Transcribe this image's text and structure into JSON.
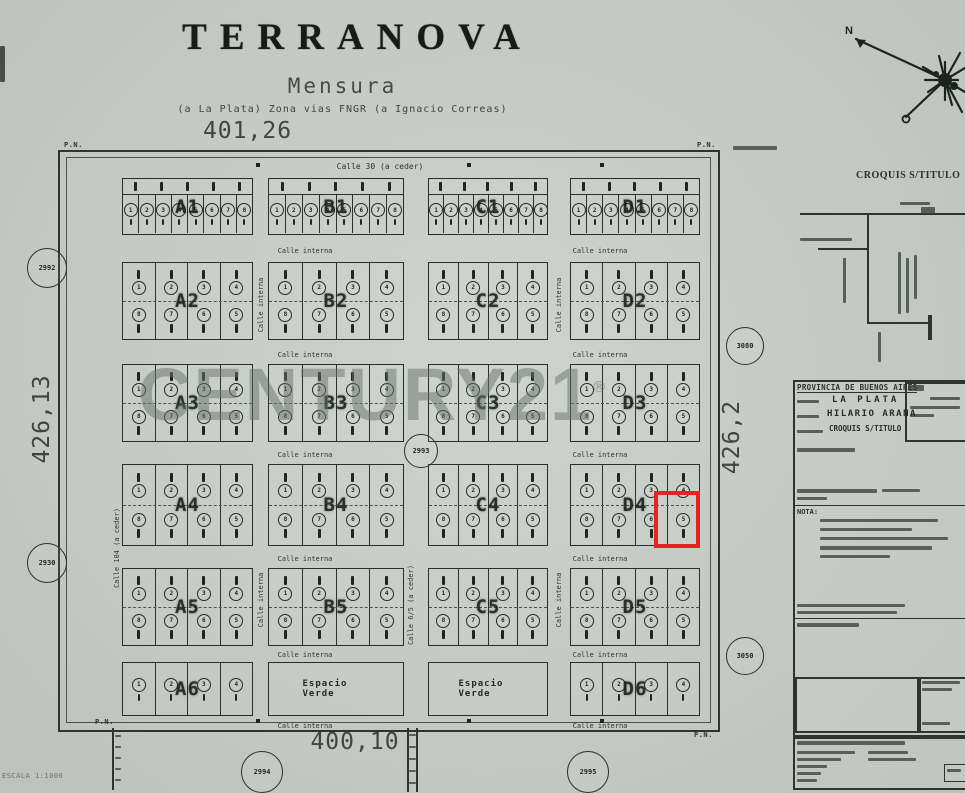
{
  "title": "TERRANOVA",
  "subtitle": "Mensura",
  "subtitle2": "(a La Plata) Zona vias FNGR (a Ignacio Correas)",
  "dimensions": {
    "top": "401,26",
    "left": "426,13",
    "right": "426,2",
    "bottom": "400,10"
  },
  "scale_note": "ESCALA 1:1000",
  "corner_label": "P.N.",
  "espacio_verde": "Espacio Verde",
  "watermark": {
    "text": "CENTURY21",
    "reg": "®"
  },
  "compass": {
    "north": "N"
  },
  "highlight_color": "#e42420",
  "streets": {
    "top": {
      "text": "Calle 30 (a ceder)",
      "x": 380,
      "y": 162
    },
    "internal_label": "Calle interna",
    "internal_positions": [
      [
        305,
        247
      ],
      [
        600,
        247
      ],
      [
        305,
        351
      ],
      [
        600,
        351
      ],
      [
        305,
        451
      ],
      [
        600,
        451
      ],
      [
        305,
        555
      ],
      [
        600,
        555
      ],
      [
        305,
        651
      ],
      [
        600,
        651
      ],
      [
        305,
        722
      ],
      [
        600,
        722
      ]
    ],
    "vertical": [
      {
        "text": "Calle 104 (a ceder)",
        "x": 117,
        "y": 548
      },
      {
        "text": "Calle 6/5 (a ceder)",
        "x": 411,
        "y": 605
      },
      {
        "text": "Calle interna",
        "x": 261,
        "y": 305
      },
      {
        "text": "Calle interna",
        "x": 559,
        "y": 305
      },
      {
        "text": "Calle interna",
        "x": 261,
        "y": 600
      },
      {
        "text": "Calle interna",
        "x": 559,
        "y": 600
      }
    ]
  },
  "map": {
    "frame": {
      "x": 58,
      "y": 150,
      "w": 658,
      "h": 578
    },
    "inner": {
      "x": 66,
      "y": 157,
      "w": 643,
      "h": 564
    },
    "columns": [
      {
        "x": 122,
        "w": 131
      },
      {
        "x": 268,
        "w": 136
      },
      {
        "x": 428,
        "w": 120
      },
      {
        "x": 570,
        "w": 130
      }
    ],
    "rows": [
      {
        "y": 178,
        "h": 57,
        "kind": "strip",
        "blocks": [
          "A1",
          "B1",
          "C1",
          "D1"
        ]
      },
      {
        "y": 262,
        "h": 78,
        "kind": "quad",
        "blocks": [
          "A2",
          "B2",
          "C2",
          "D2"
        ]
      },
      {
        "y": 364,
        "h": 78,
        "kind": "quad",
        "blocks": [
          "A3",
          "B3",
          "C3",
          "D3"
        ]
      },
      {
        "y": 464,
        "h": 82,
        "kind": "quad",
        "blocks": [
          "A4",
          "B4",
          "C4",
          "D4"
        ]
      },
      {
        "y": 568,
        "h": 78,
        "kind": "quad",
        "blocks": [
          "A5",
          "B5",
          "C5",
          "D5"
        ]
      },
      {
        "y": 662,
        "h": 54,
        "kind": "flat",
        "blocks": [
          "A6",
          "EV1",
          "EV2",
          "D6"
        ]
      }
    ],
    "strip_lots": [
      1,
      2,
      3,
      4,
      5,
      6,
      7,
      8
    ],
    "quad_lots_top": [
      1,
      2,
      3,
      4
    ],
    "quad_lots_bottom": [
      8,
      7,
      6,
      5
    ],
    "flat_lots": [
      1,
      2,
      3,
      4
    ],
    "corner_positions": [
      [
        64,
        141
      ],
      [
        697,
        141
      ],
      [
        95,
        718
      ],
      [
        694,
        731
      ]
    ],
    "circles": [
      {
        "label": "2992",
        "x": 47,
        "y": 268,
        "r": 20
      },
      {
        "label": "2930",
        "x": 47,
        "y": 563,
        "r": 20
      },
      {
        "label": "2993",
        "x": 421,
        "y": 451,
        "r": 17
      },
      {
        "label": "2994",
        "x": 262,
        "y": 772,
        "r": 21
      },
      {
        "label": "2995",
        "x": 588,
        "y": 772,
        "r": 21
      },
      {
        "label": "3080",
        "x": 745,
        "y": 346,
        "r": 19
      },
      {
        "label": "3050",
        "x": 745,
        "y": 656,
        "r": 19
      }
    ],
    "highlight": {
      "x": 654,
      "y": 491,
      "w": 46,
      "h": 57
    }
  },
  "panel": {
    "caption": "CROQUIS S/TITULO",
    "header": "PROVINCIA DE BUENOS AIRES",
    "partido_value": "LA PLATA",
    "localidad_value": "HILARIO ARANA",
    "plano_value": "CROQUIS S/TITULO",
    "nota_label": "NOTA:"
  }
}
